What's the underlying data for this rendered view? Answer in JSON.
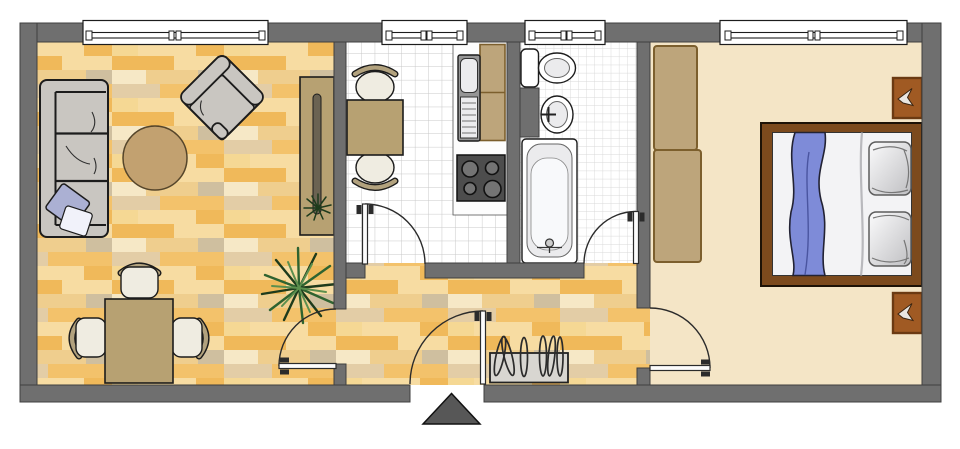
{
  "plan": {
    "rooms": [
      "living-room",
      "kitchen",
      "bathroom",
      "bedroom",
      "hallway"
    ],
    "living_room_items": [
      "sofa",
      "sofa-pillows",
      "round-rug",
      "armchair",
      "sideboard",
      "shelf-plant",
      "palm-plant",
      "dining-table",
      "three-dining-chairs"
    ],
    "kitchen_items": [
      "kitchen-table",
      "two-kitchen-chairs",
      "counter",
      "sink-unit",
      "upper-cabinets",
      "stove-four-burners"
    ],
    "bathroom_items": [
      "toilet",
      "wash-basin",
      "bathtub"
    ],
    "bedroom_items": [
      "wardrobe",
      "double-bed",
      "blanket",
      "two-pillows",
      "two-nightstands"
    ],
    "hallway_items": [
      "coat-rack",
      "entrance-marker-triangle"
    ],
    "window_count": 4,
    "interior_door_count": 4,
    "entrance_door_count": 1
  },
  "colors": {
    "wall": "#6f6f6f",
    "wall_edge": "#3f3f3f",
    "outline": "#1c1c1c",
    "door_line": "#2b2b2b",
    "leaf_fill": "#fcfcfc",
    "window_fill": "#ffffff",
    "wood1": "#f7dca2",
    "wood2": "#f0b95a",
    "wood3": "#efce8e",
    "wood4": "#e3cda6",
    "wood5": "#f6e8c6",
    "wood6": "#cfbf9f",
    "wood7": "#f3c26b",
    "wood8": "#f5d894",
    "tile_white": "#ffffff",
    "tile_line": "#c9c9c9",
    "tile_line_b": "#d8d8d8",
    "floor_bedroom": "#f4e5c6",
    "furniture_gray": "#c9c6c1",
    "wrinkle": "#2e2e2e",
    "tan": "#b7a172",
    "rug": "#c2a170",
    "rug_edge": "#55452a",
    "seat_white": "#efece1",
    "chairback": "#b2a27e",
    "counter": "#fdfdfd",
    "sink_gray": "#969696",
    "basin": "#ececee",
    "stove_body": "#4d4d4d",
    "burner": "#747474",
    "fixture_white": "#ffffff",
    "fixture_inner": "#ebebed",
    "coatrack": "#d8d6d1",
    "wardrobe": "#bda57b",
    "wardrobe_edge": "#7c5f2d",
    "bed_frame": "#7c4a1d",
    "bed_frame_edge": "#1d1206",
    "mattress": "#f3f3f5",
    "blanket": "#7e8bd8",
    "blanket_line": "#4a55a0",
    "sheet_line": "#b9b9bd",
    "pillow_light": "#fbfbfc",
    "pillow_dark": "#bfbfc2",
    "pillow_edge": "#5c5c5c",
    "cabinet": "#a05a23",
    "cabinet_edge": "#6b3a12",
    "cabinet_glyph": "#e9e6e1",
    "pillow_sofa": "#abb0d3",
    "pillow_sofa2": "#f1f2fa",
    "plant_dark": "#1e3b1c",
    "plant_mid": "#2f6330",
    "plant_light": "#5c8f4e",
    "slot": "#6b6352",
    "triangle": "#575757"
  }
}
